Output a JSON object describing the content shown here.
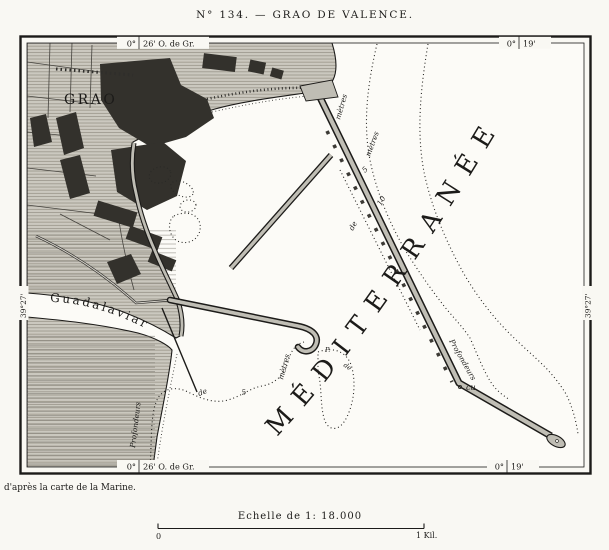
{
  "title": "N° 134. — GRAO DE VALENCE.",
  "frame": {
    "top_left": {
      "deg": "0°",
      "min": "26' O. de Gr."
    },
    "top_right": {
      "deg": "0°",
      "min": "19'"
    },
    "bottom_left": {
      "deg": "0°",
      "min": "26' O. de Gr."
    },
    "bottom_right": {
      "deg": "0°",
      "min": "19'"
    },
    "left_lat": "39°27'",
    "right_lat": "39°27'"
  },
  "map": {
    "sea": "MÉDITERRANÉE",
    "town": "GRAO",
    "river": "Guadalaviar",
    "depth": {
      "sw_profondeurs": "Profondeurs",
      "sw_de": "de",
      "sw_5": "5",
      "sw_metres": "mètres",
      "hook_p": "P.",
      "hook_de": "de",
      "ne_metres_1": "mètres",
      "ne_metres_2": "mètres",
      "ne_5": "5",
      "ne_10": "10",
      "ne_de": "de",
      "se_profondeurs": "Profondeurs",
      "se_cu": "cu"
    }
  },
  "credit": "d'après la carte de la Marine.",
  "scale": {
    "caption": "Echelle de 1: 18.000",
    "start": "0",
    "end": "1 Kil."
  }
}
